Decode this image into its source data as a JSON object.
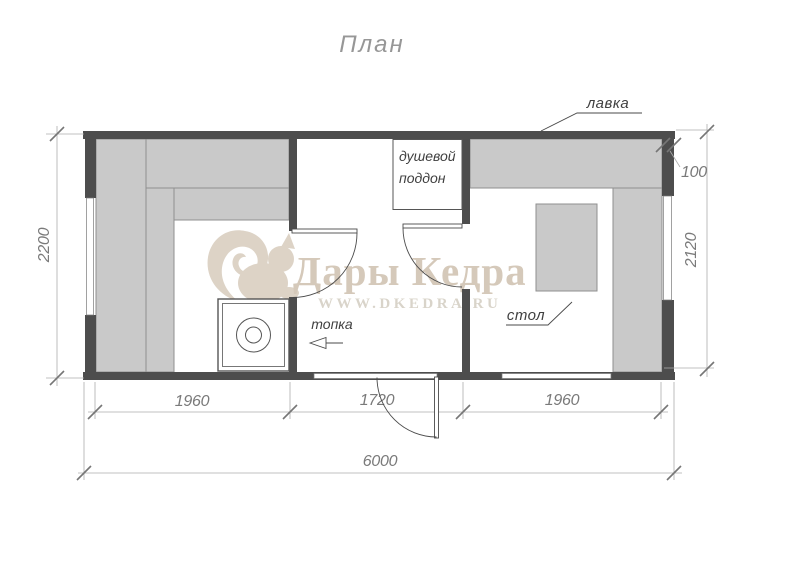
{
  "title": "План",
  "watermark": {
    "brand": "Дары Кедра",
    "site": "WWW.DKEDRA.RU",
    "logo_icon": "squirrel-icon"
  },
  "labels": {
    "bench": "лавка",
    "table": "стол",
    "firebox": "топка",
    "shower_tray_line1": "душевой",
    "shower_tray_line2": "поддон"
  },
  "dimensions": {
    "outer_height_left": "2200",
    "inner_height_right": "2120",
    "wall_thickness": "100",
    "span_left": "1960",
    "span_middle": "1720",
    "span_right": "1960",
    "total_length": "6000"
  },
  "colors": {
    "wall": "#4d4d4d",
    "bench_fill": "#c9c9c9",
    "bench_border": "#8f8f8f",
    "drawing_line": "#4a4a4a",
    "dimension_line": "#adadad",
    "dimension_text": "#7a7a7a",
    "watermark_text": "#d5c9ba",
    "watermark_logo": "#ddd3c6",
    "title_text": "#979797"
  }
}
